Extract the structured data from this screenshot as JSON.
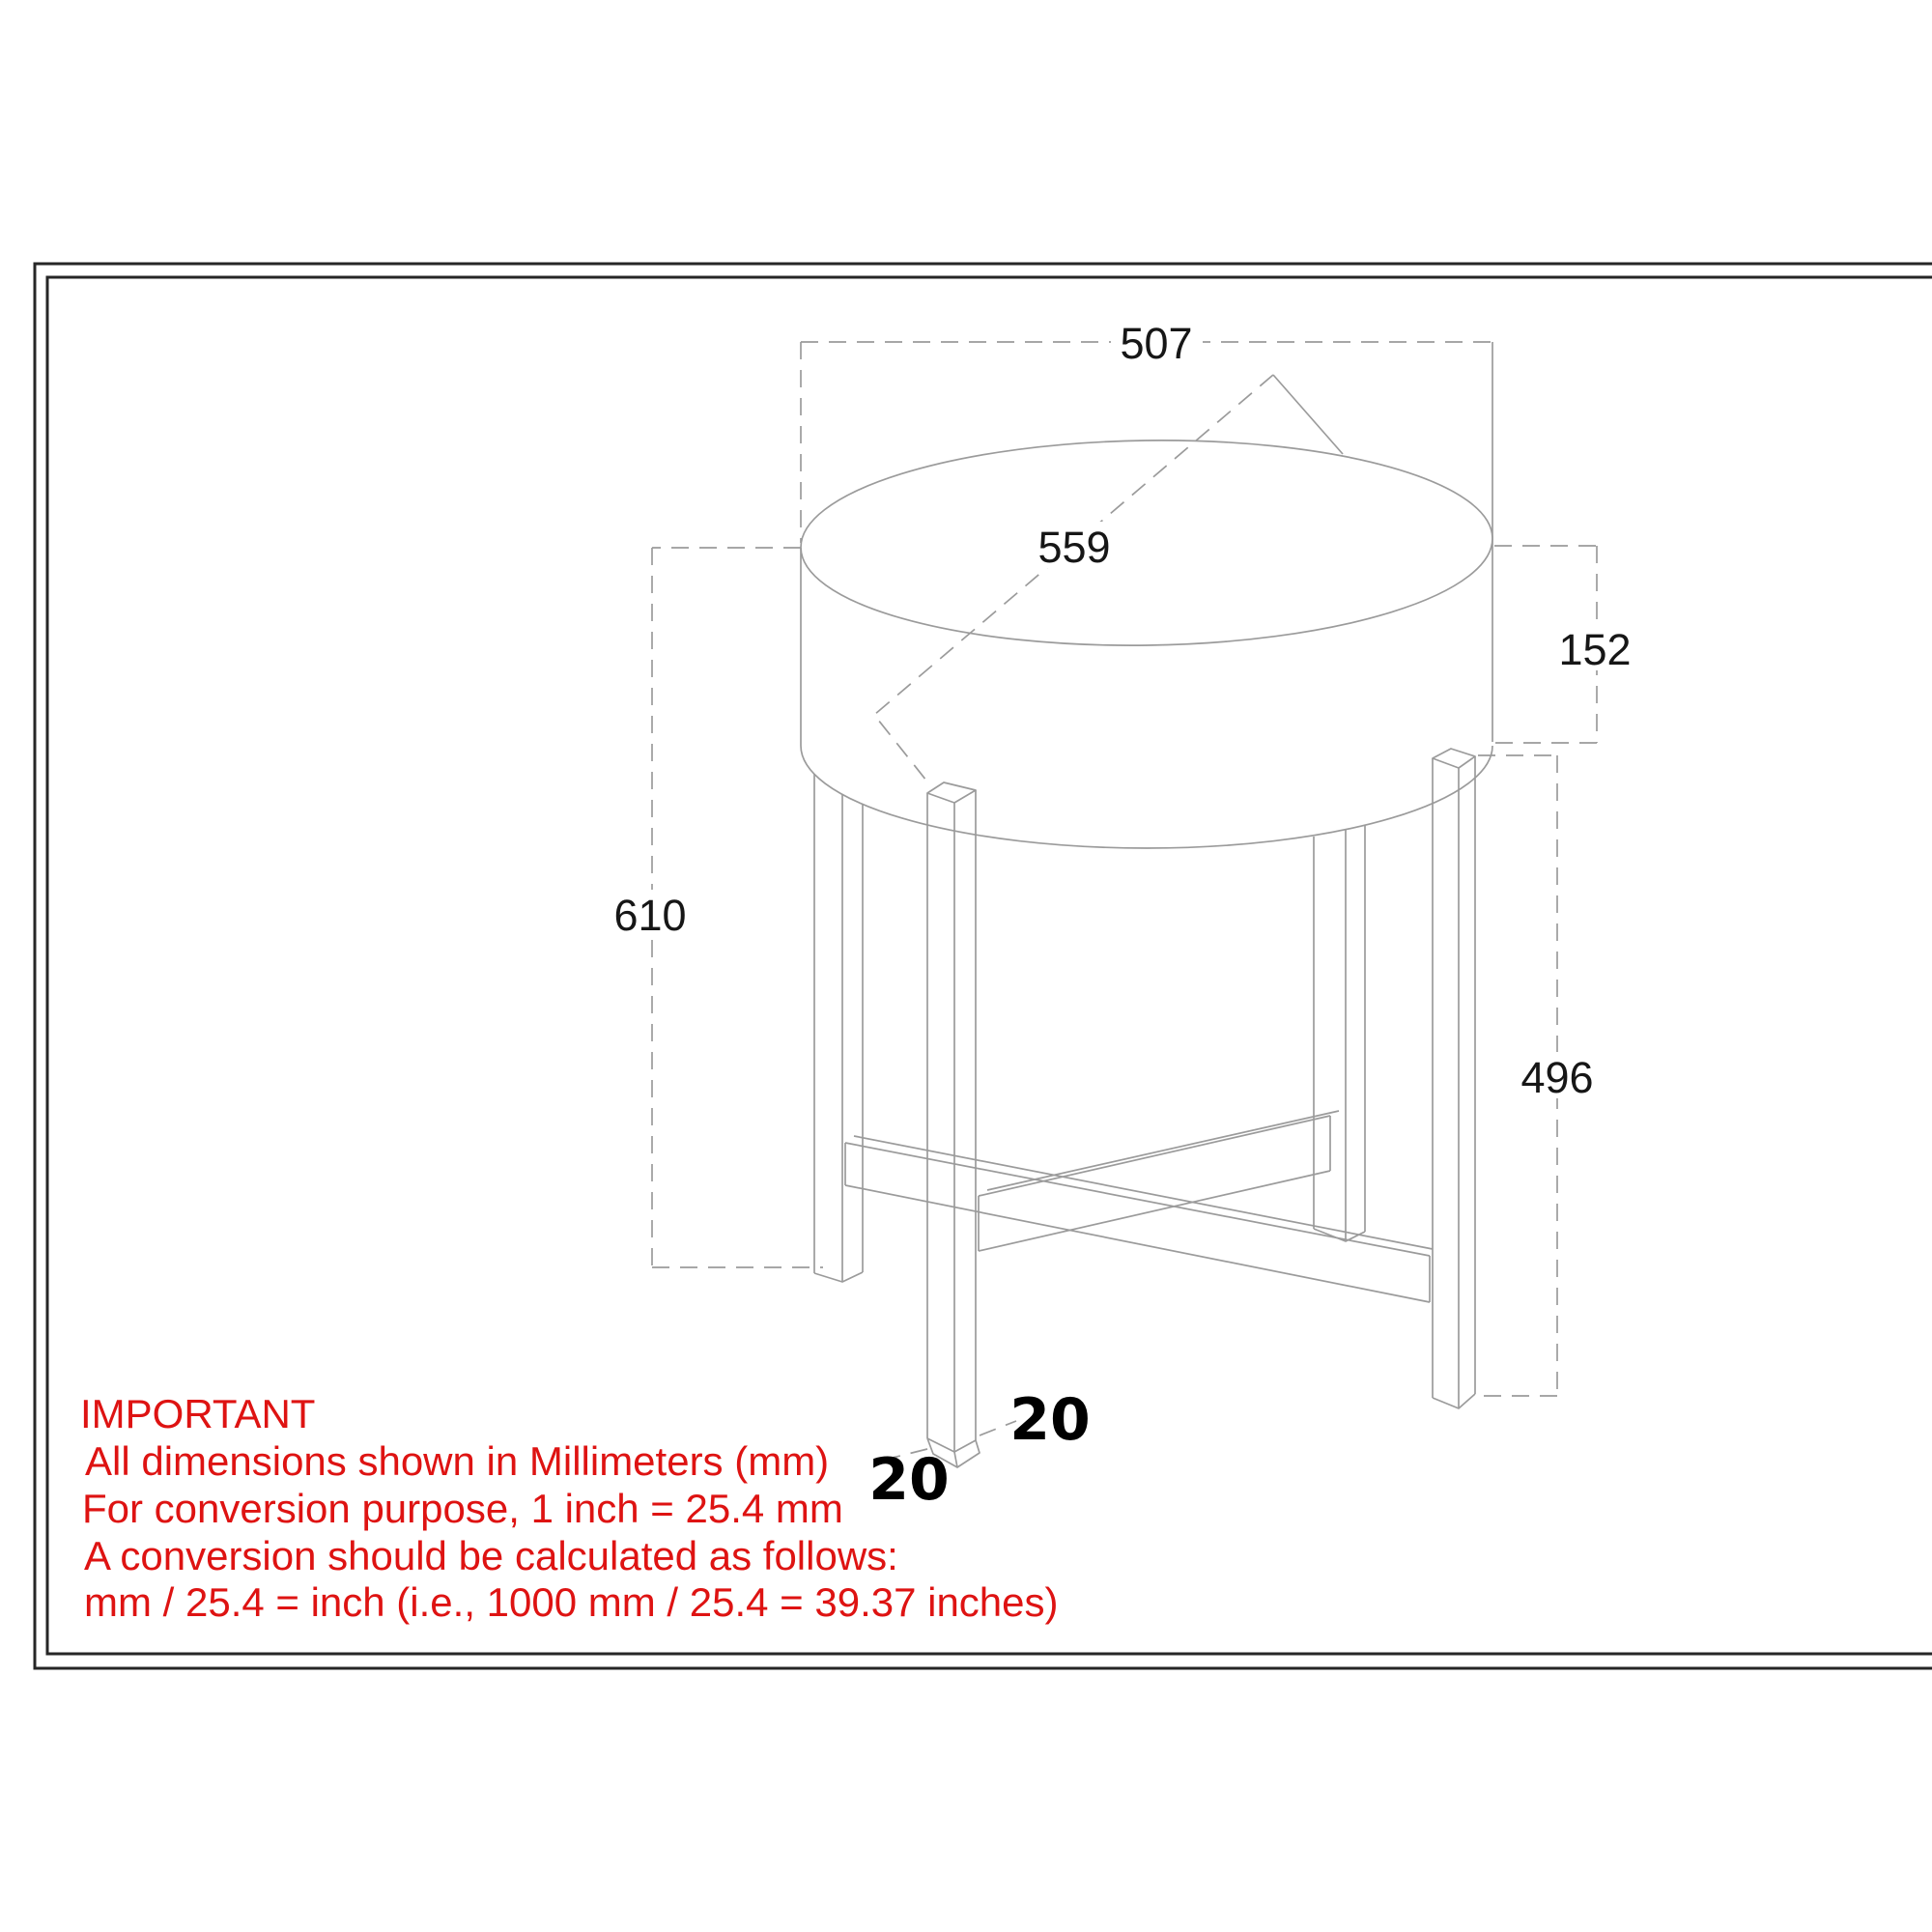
{
  "page": {
    "background": "#ffffff"
  },
  "frame": {
    "color": "#262626"
  },
  "drawing": {
    "line_color": "#9b9b9b",
    "dimensions": {
      "top_width": "507",
      "top_diameter": "559",
      "top_thickness": "152",
      "overall_height": "610",
      "leg_height": "496",
      "leg_thickness_right": "20",
      "leg_thickness_left": "20"
    }
  },
  "note": {
    "color": "#de1312",
    "title": "IMPORTANT",
    "lines": [
      "All dimensions shown in Millimeters (mm)",
      "For conversion purpose, 1 inch = 25.4 mm",
      "A conversion should be calculated as follows:",
      "mm / 25.4 = inch (i.e., 1000 mm / 25.4 = 39.37 inches)"
    ]
  }
}
